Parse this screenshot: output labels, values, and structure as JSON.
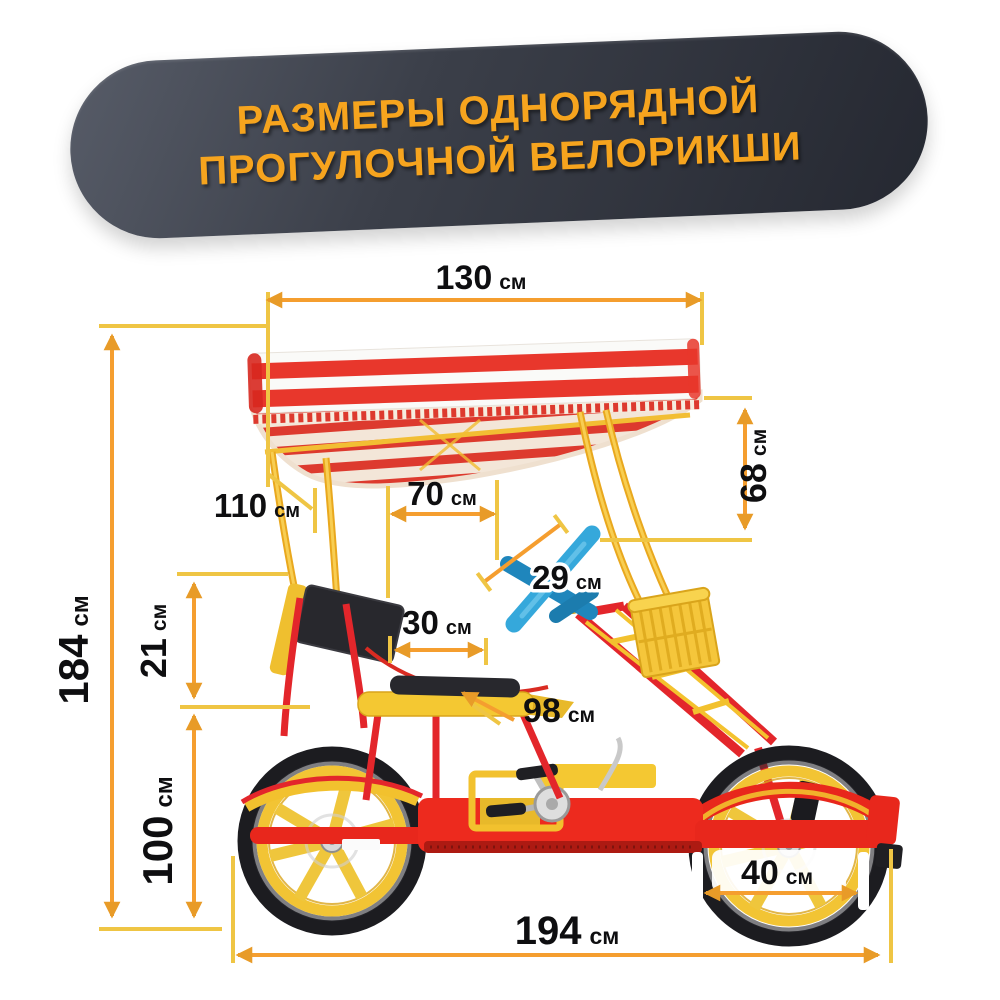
{
  "title": {
    "line1": "РАЗМЕРЫ ОДНОРЯДНОЙ",
    "line2": "ПРОГУЛОЧНОЙ ВЕЛОРИКШИ"
  },
  "dimensions": {
    "canopy_width": {
      "value": "130",
      "unit": "см"
    },
    "canopy_side_height": {
      "value": "68",
      "unit": "см"
    },
    "canopy_pole_height": {
      "value": "110",
      "unit": "см"
    },
    "overall_height": {
      "value": "184",
      "unit": "см"
    },
    "backrest_height": {
      "value": "21",
      "unit": "см"
    },
    "seat_height": {
      "value": "100",
      "unit": "см"
    },
    "seat_to_handlebar": {
      "value": "70",
      "unit": "см"
    },
    "handlebar_size": {
      "value": "29",
      "unit": "см"
    },
    "seat_depth": {
      "value": "30",
      "unit": "см"
    },
    "seat_front_length": {
      "value": "98",
      "unit": "см"
    },
    "overall_length": {
      "value": "194",
      "unit": "см"
    },
    "wheel_diameter": {
      "value": "40",
      "unit": "см"
    }
  },
  "colors": {
    "dimension_line": "#F59E2F",
    "extension_line": "#EFC544",
    "arrowhead": "#E89B28",
    "banner_background": "#3b3f49",
    "banner_text": "#F6A41E",
    "frame_red": "#E8271C",
    "accent_yellow": "#F2C12E",
    "handlebar_blue": "#35A8DB",
    "canopy_red": "#E8372C",
    "tire_black": "#1C1C20"
  }
}
